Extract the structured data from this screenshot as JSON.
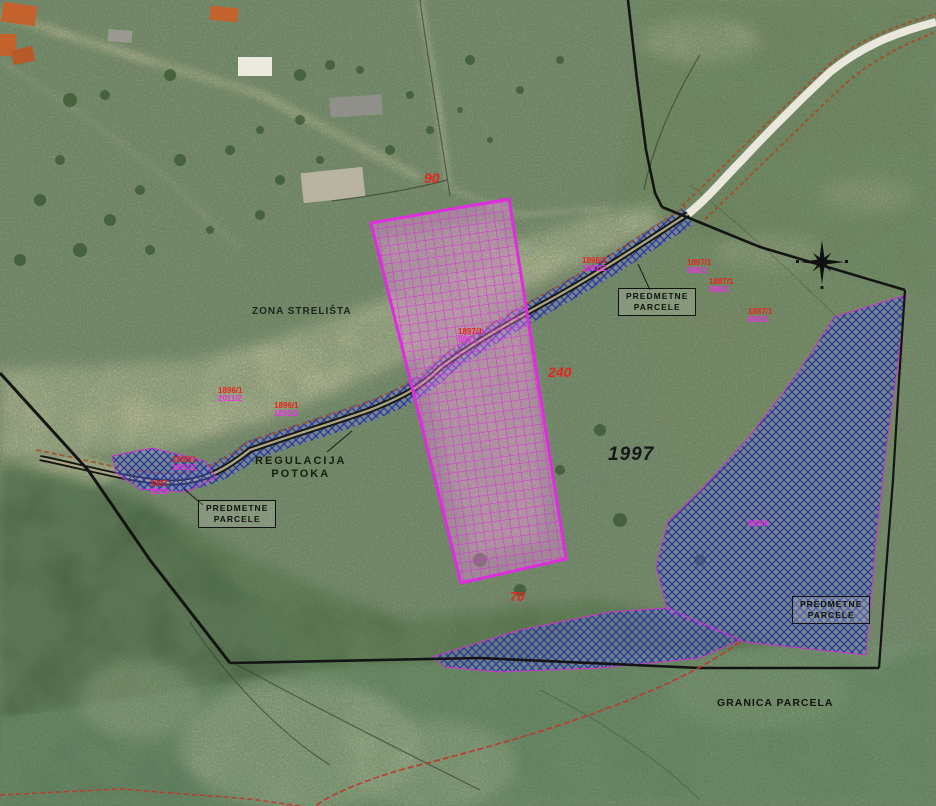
{
  "map": {
    "region_labels": {
      "zona_strelista": "ZONA STRELIŠTA",
      "regulacija_line1": "REGULACIJA",
      "regulacija_line2": "POTOKA",
      "granica_parcela": "GRANICA PARCELA"
    },
    "predmetne_box": {
      "line1": "PREDMETNE",
      "line2": "PARCELE"
    },
    "measurements": {
      "top": "90",
      "middle": "240",
      "bottom": "70"
    },
    "parcel_number_black": "1997",
    "parcel_labels": [
      {
        "red": "1896/1",
        "magenta": "2011/2"
      },
      {
        "red": "1896/1",
        "magenta": "1891/2"
      },
      {
        "red": "1896/1",
        "magenta": "1891/2"
      },
      {
        "red": "1897",
        "magenta": "2012"
      },
      {
        "red": "1896/1",
        "magenta": "1891/2"
      },
      {
        "red": "1897/1",
        "magenta": "888/2"
      },
      {
        "red": "1887/1",
        "magenta": "888/2"
      },
      {
        "red": "1887/1",
        "magenta": "888/2"
      },
      {
        "red": "",
        "magenta": "888/4"
      },
      {
        "red": "1897/1",
        "magenta": "888"
      }
    ],
    "icons": {
      "compass": "compass-rose-icon"
    }
  },
  "colors": {
    "label-red": "#e8251d",
    "label-magenta": "#f02ce8",
    "zone-magenta": "#e02ce0",
    "parcel-blue": "#2733a0",
    "boundary-black": "#141414",
    "stream-brown": "#a0522d"
  }
}
